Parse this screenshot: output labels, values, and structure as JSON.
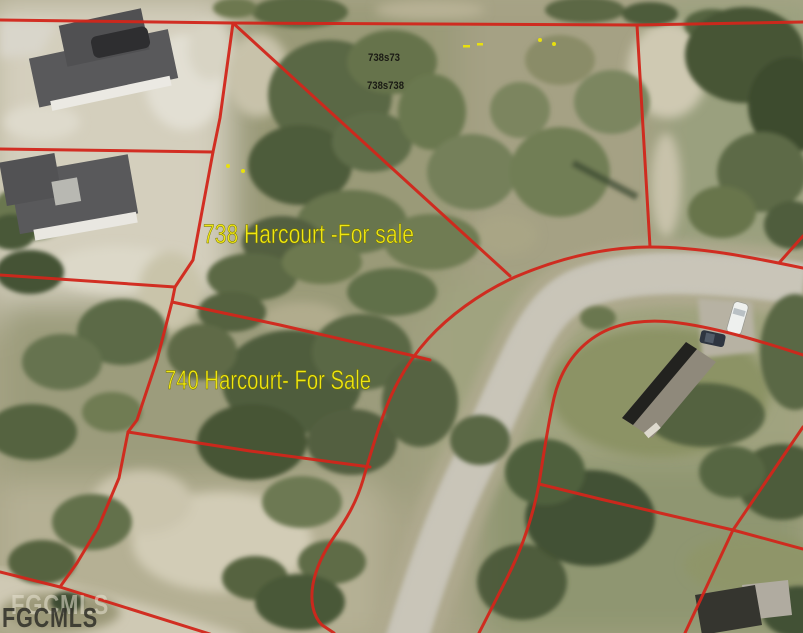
{
  "window": {
    "width": 803,
    "height": 633
  },
  "listing_map": {
    "labels": {
      "lot738": "738 Harcourt -For sale",
      "lot740": "740 Harcourt- For Sale"
    },
    "parcel_numbers": {
      "line1": "738s73",
      "line2": "738s738"
    },
    "watermark": "FGCMLS",
    "colors": {
      "boundary_red": "#d2261b",
      "label_yellow": "#f0e713",
      "road_gray": "#c6c2b5",
      "sand": "#d4cfbd",
      "vegetation_green": "#5a6845"
    }
  }
}
